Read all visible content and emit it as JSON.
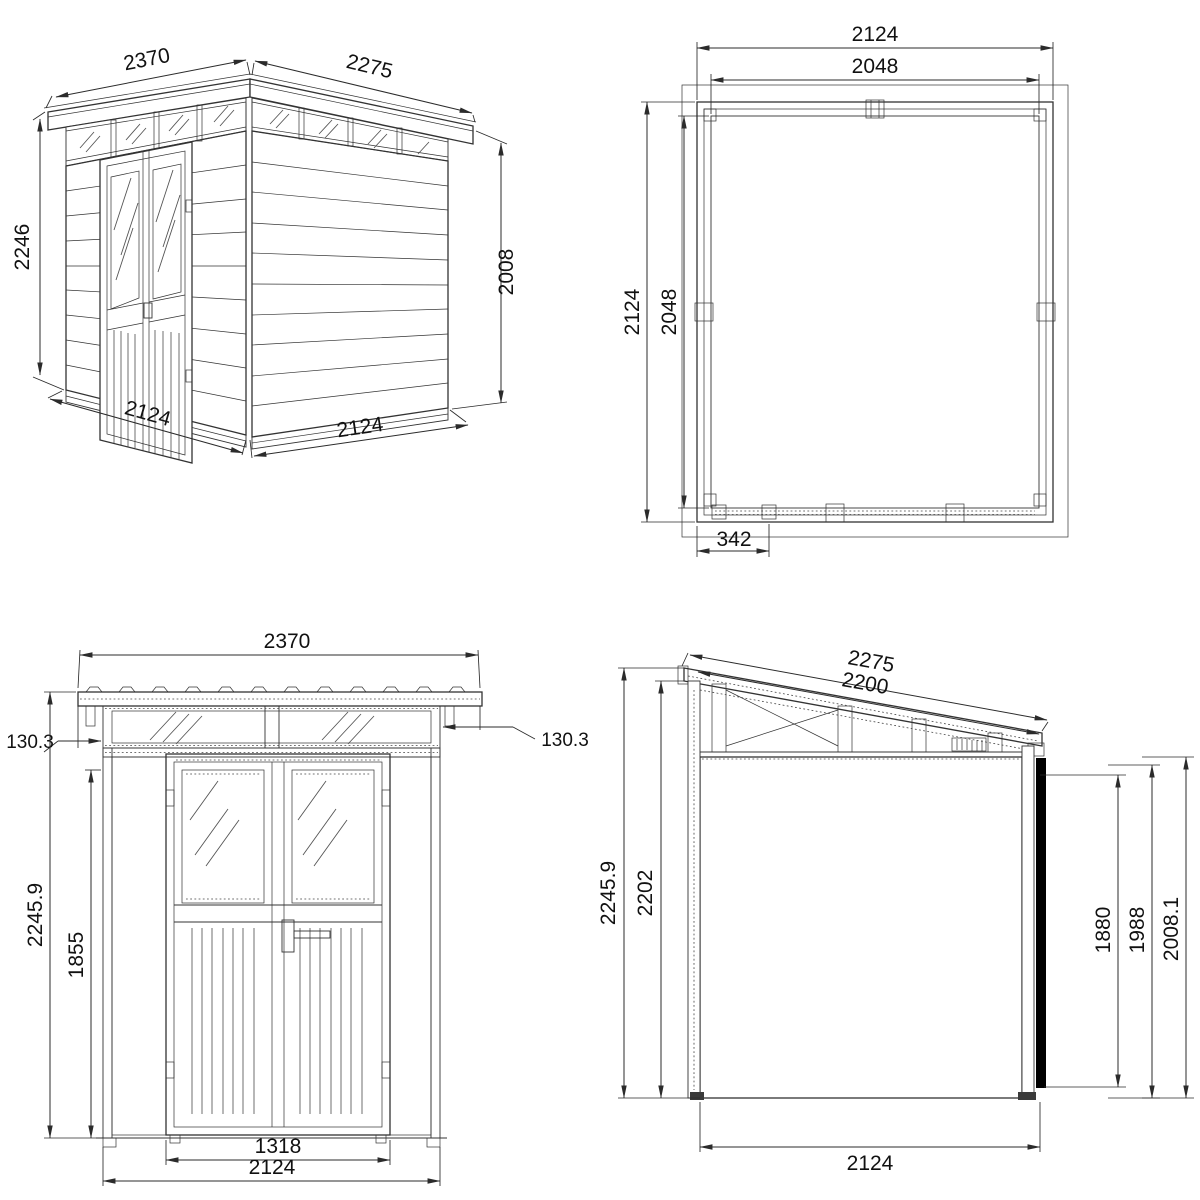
{
  "colors": {
    "line": "#333333",
    "siding_light": "#b9b98c",
    "siding_dark": "#8a8a5e",
    "background": "#ffffff"
  },
  "perspective": {
    "roof_front": "2370",
    "roof_side": "2275",
    "height_front": "2246",
    "height_rear": "2008",
    "base_front": "2124",
    "base_side": "2124"
  },
  "floor_plan": {
    "width_outer": "2124",
    "width_inner": "2048",
    "depth_outer": "2124",
    "depth_inner": "2048",
    "door_offset": "342"
  },
  "front_elevation": {
    "roof_width": "2370",
    "overhang_left": "130.3",
    "overhang_right": "130.3",
    "height_total": "2245.9",
    "height_opening": "1855",
    "door_width": "1318",
    "width": "2124"
  },
  "side_elevation": {
    "roof_length": "2275",
    "roof_inner": "2200",
    "height_total": "2245.9",
    "height_front": "2202",
    "height_rear_inner": "1880",
    "height_rear": "1988",
    "height_rear_total": "2008.1",
    "depth": "2124"
  }
}
